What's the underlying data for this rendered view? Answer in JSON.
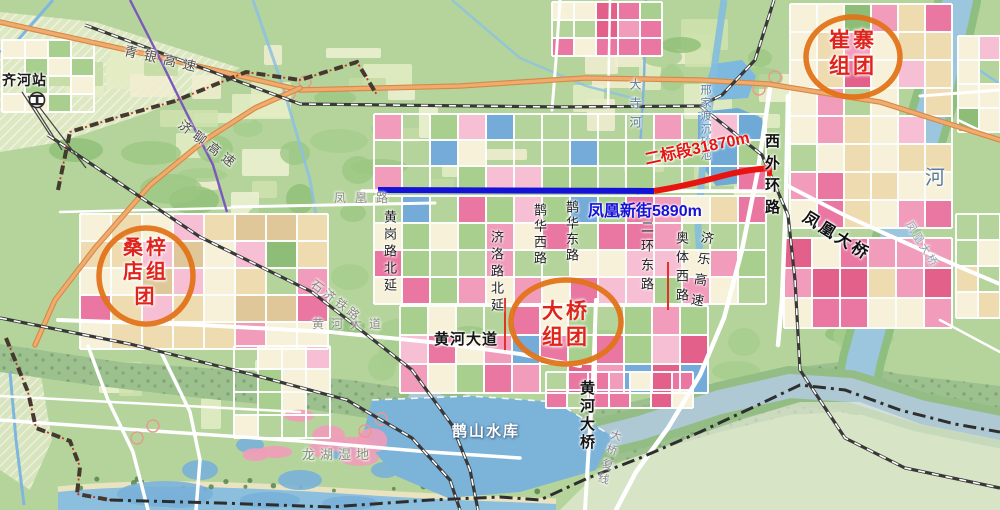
{
  "map": {
    "clusters": {
      "cuizhai": {
        "line1": "崔寨",
        "line2": "组团"
      },
      "sangzidian": {
        "line1": "桑梓",
        "line2": "店组",
        "line3": "团"
      },
      "daqiao": {
        "line1": "大桥",
        "line2": "组团"
      }
    },
    "measurements": {
      "bid_section_2": "二标段31870m",
      "fenghuang_new_street": "凤凰新街5890m"
    },
    "feature_labels": [
      {
        "name": "qihe-station",
        "text": "齐河站",
        "x": 2,
        "y": 73,
        "size": 14,
        "color": "#1a1a1a",
        "bold": true,
        "ls": 1
      },
      {
        "name": "qingyin-expressway",
        "text": "青银高速",
        "x": 126,
        "y": 44,
        "size": 13,
        "color": "#4c4c44",
        "rot": 13,
        "ls": 7
      },
      {
        "name": "jiliao-expressway",
        "text": "济聊高速",
        "x": 184,
        "y": 118,
        "size": 13,
        "color": "#4c4c44",
        "rot": 37,
        "ls": 5
      },
      {
        "name": "fenghuang-road",
        "text": "凤凰路",
        "x": 334,
        "y": 192,
        "size": 12,
        "color": "#8b8b84",
        "ls": 9
      },
      {
        "name": "huanggang-road-north-ext",
        "text": "黄岗路北延",
        "x": 383,
        "y": 210,
        "size": 13,
        "color": "#1f1f1f",
        "vert": true,
        "ls": 4
      },
      {
        "name": "jiluo-road-north-ext",
        "text": "济洛路北延",
        "x": 490,
        "y": 230,
        "size": 13,
        "color": "#1f1f1f",
        "vert": true,
        "ls": 4
      },
      {
        "name": "quehua-west-road",
        "text": "鹊华西路",
        "x": 533,
        "y": 203,
        "size": 13,
        "color": "#1f1f1f",
        "vert": true,
        "ls": 3
      },
      {
        "name": "quehua-east-road",
        "text": "鹊华东路",
        "x": 565,
        "y": 200,
        "size": 13,
        "color": "#1f1f1f",
        "vert": true,
        "ls": 3
      },
      {
        "name": "erhuan-east-road",
        "text": "二环东路",
        "x": 640,
        "y": 220,
        "size": 13,
        "color": "#1f1f1f",
        "vert": true,
        "ls": 6
      },
      {
        "name": "aoti-west-road",
        "text": "奥体西路",
        "x": 675,
        "y": 231,
        "size": 13,
        "color": "#1f1f1f",
        "vert": true,
        "ls": 6
      },
      {
        "name": "jile-expressway",
        "text": "济乐高速",
        "x": 701,
        "y": 230,
        "size": 13,
        "color": "#1f1f1f",
        "vert": true,
        "ls": 8,
        "rot": 9
      },
      {
        "name": "west-outer-ring-road",
        "text": "西外环路",
        "x": 764,
        "y": 133,
        "size": 15,
        "color": "#111111",
        "bold": true,
        "vert": true,
        "ls": 7
      },
      {
        "name": "fenghuang-bridge",
        "text": "凤凰大桥",
        "x": 808,
        "y": 210,
        "size": 16,
        "color": "#111111",
        "bold": true,
        "rot": 32,
        "ls": 3
      },
      {
        "name": "fenghuang-bridge-road",
        "text": "凤凰大桥",
        "x": 912,
        "y": 220,
        "size": 11,
        "color": "#93a4b0",
        "rot": 58,
        "ls": 2
      },
      {
        "name": "river",
        "text": "河",
        "x": 925,
        "y": 168,
        "size": 20,
        "color": "#5c7d96"
      },
      {
        "name": "dasi-river",
        "text": "大寺河",
        "x": 629,
        "y": 78,
        "size": 12,
        "color": "#5c7d96",
        "vert": true,
        "ls": 7
      },
      {
        "name": "xingjiadu-basin",
        "text": "邢家渡沉砂池",
        "x": 699,
        "y": 84,
        "size": 11,
        "color": "#567d9c",
        "vert": true,
        "ls": 2
      },
      {
        "name": "huanghe-avenue-map",
        "text": "黄河大道",
        "x": 312,
        "y": 318,
        "size": 12,
        "color": "#8b8b84",
        "ls": 7
      },
      {
        "name": "huanghe-avenue",
        "text": "黄河大道",
        "x": 434,
        "y": 332,
        "size": 15,
        "color": "#151515",
        "bold": true,
        "ls": 1
      },
      {
        "name": "shiji-railway",
        "text": "石济铁路",
        "x": 316,
        "y": 278,
        "size": 12,
        "color": "#85857e",
        "rot": 37,
        "ls": 3
      },
      {
        "name": "huanghe-bridge",
        "text": "黄河大桥",
        "x": 579,
        "y": 380,
        "size": 15,
        "color": "#151515",
        "bold": true,
        "vert": true,
        "ls": 3
      },
      {
        "name": "bridge-second-line",
        "text": "大桥复线",
        "x": 611,
        "y": 428,
        "size": 11,
        "color": "#85858d",
        "vert": true,
        "ls": 4,
        "rot": 16
      },
      {
        "name": "queshan-reservoir",
        "text": "鹊山水库",
        "x": 452,
        "y": 424,
        "size": 15,
        "color": "#ffffff",
        "bold": true,
        "ls": 2,
        "halo": "dark"
      },
      {
        "name": "longhu-wetland",
        "text": "龙湖湿地",
        "x": 302,
        "y": 448,
        "size": 13,
        "color": "#7c9376",
        "ls": 5
      }
    ],
    "colors": {
      "cluster_ring": "#e2731a",
      "cluster_text": "#df241b",
      "bid_line": "#e81410",
      "street_line": "#1512d8",
      "expressway": "#f0ac6e",
      "water": "#8fc0de",
      "urban_pink": "#f19cba",
      "urban_cream": "#f6f0d8"
    }
  }
}
